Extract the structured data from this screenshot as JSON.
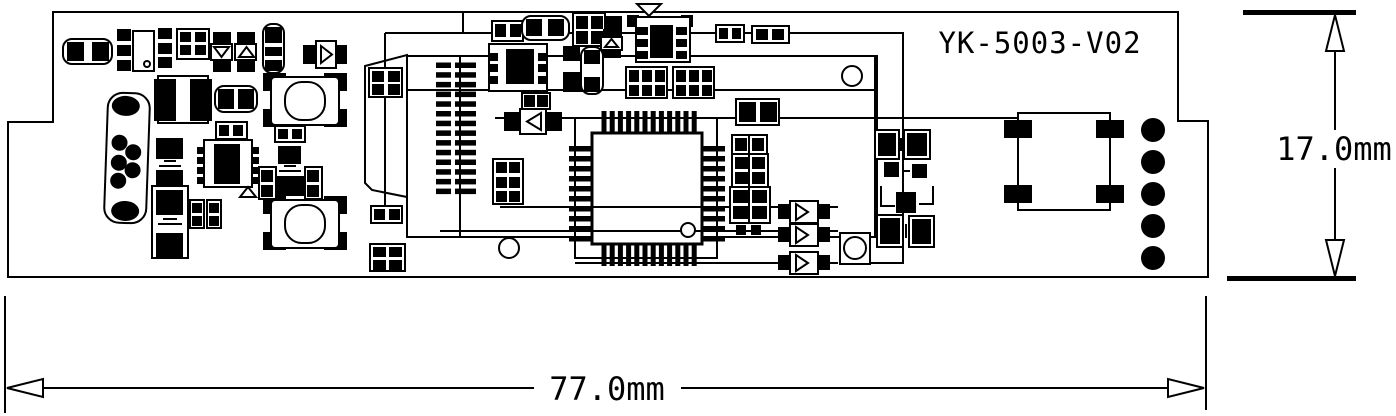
{
  "drawing": {
    "title": "YK-5003-V02",
    "width_dimension_label": "77.0mm",
    "height_dimension_label": "17.0mm"
  },
  "colors": {
    "ink": "#000000",
    "paper": "#ffffff"
  }
}
